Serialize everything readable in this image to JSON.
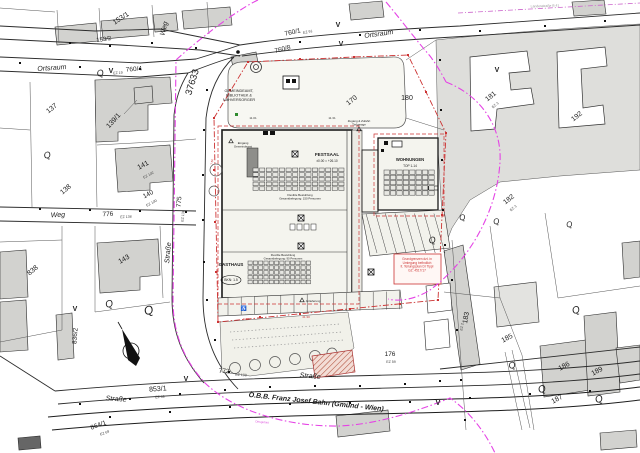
{
  "colors": {
    "ink": "#1c1c1c",
    "line": "#2b2b2b",
    "red": "#cc3333",
    "magenta": "#e543e5",
    "building_gray": "#d2d2cf",
    "zone_gray": "#dededb",
    "site_fill": "#f4f4ee",
    "plaza_fill": "#f7f7f2",
    "green": "#2e8b2e"
  },
  "site": {
    "festsaal": {
      "seat_cols": 14,
      "seat_rows": 5
    },
    "gasthaus": {
      "seat_cols": 12,
      "seat_rows": 5
    },
    "wohnungen": {
      "storage_cols": 8,
      "storage_rows": 5
    },
    "parking": {
      "stalls": 13,
      "diagonal_stalls": 8
    }
  },
  "labels": [
    {
      "id": "street-ortsraum-top",
      "text": "Ortsraum",
      "x": 379,
      "y": 36,
      "rot": -8,
      "size": 7,
      "italic": true
    },
    {
      "id": "street-ortsraum-left",
      "text": "Ortsraum",
      "x": 52,
      "y": 70,
      "rot": -4,
      "size": 7,
      "italic": true
    },
    {
      "id": "street-weg-top",
      "text": "Weg",
      "x": 166,
      "y": 29,
      "rot": -76,
      "size": 7,
      "italic": true
    },
    {
      "id": "street-weg-left",
      "text": "Weg",
      "x": 58,
      "y": 217,
      "rot": -3,
      "size": 7,
      "italic": true
    },
    {
      "id": "street-strasse-left",
      "text": "Straße",
      "x": 170,
      "y": 253,
      "rot": -85,
      "size": 7,
      "italic": true
    },
    {
      "id": "street-strasse-bottom-left",
      "text": "Straße",
      "x": 116,
      "y": 401,
      "rot": 4,
      "size": 7,
      "italic": true
    },
    {
      "id": "street-strasse-bottom-center",
      "text": "Straße",
      "x": 310,
      "y": 378,
      "rot": 5,
      "size": 7,
      "italic": true
    },
    {
      "id": "railway-label",
      "text": "Ö.B.B.  Franz Josef Bahn (Gmünd - Wien)",
      "x": 316,
      "y": 404,
      "rot": 6,
      "size": 7,
      "bold": true,
      "italic": true
    },
    {
      "id": "parcel-153-1",
      "text": "153/1",
      "x": 122,
      "y": 20,
      "rot": -33,
      "size": 7
    },
    {
      "id": "parcel-153-2",
      "text": "153/2",
      "x": 104,
      "y": 41,
      "rot": -8,
      "size": 6
    },
    {
      "id": "parcel-760-1",
      "text": "760/1",
      "x": 293,
      "y": 34,
      "rot": -12,
      "size": 6.5
    },
    {
      "id": "parcel-760-8",
      "text": "760/8",
      "x": 283,
      "y": 51,
      "rot": -14,
      "size": 6.5
    },
    {
      "id": "parcel-760-4",
      "text": "760/4",
      "x": 134,
      "y": 71,
      "rot": -4,
      "size": 6.5
    },
    {
      "id": "parcel-37633",
      "text": "37633",
      "x": 195,
      "y": 83,
      "rot": -73,
      "size": 9.5
    },
    {
      "id": "parcel-137",
      "text": "137",
      "x": 53,
      "y": 110,
      "rot": -38,
      "size": 7
    },
    {
      "id": "parcel-139-1",
      "text": "139/1",
      "x": 115,
      "y": 122,
      "rot": -48,
      "size": 7
    },
    {
      "id": "parcel-138",
      "text": "138",
      "x": 67,
      "y": 191,
      "rot": -40,
      "size": 7
    },
    {
      "id": "parcel-141",
      "text": "141",
      "x": 144,
      "y": 167,
      "rot": -28,
      "size": 7
    },
    {
      "id": "parcel-140",
      "text": "140",
      "x": 149,
      "y": 196,
      "rot": -28,
      "size": 6.5
    },
    {
      "id": "parcel-143",
      "text": "143",
      "x": 125,
      "y": 261,
      "rot": -30,
      "size": 7
    },
    {
      "id": "parcel-776",
      "text": "776",
      "x": 108,
      "y": 216,
      "rot": -3,
      "size": 6.5
    },
    {
      "id": "parcel-775",
      "text": "775",
      "x": 181,
      "y": 202,
      "rot": -85,
      "size": 6.5
    },
    {
      "id": "parcel-838",
      "text": "838",
      "x": 34,
      "y": 272,
      "rot": -40,
      "size": 7
    },
    {
      "id": "parcel-836-2",
      "text": "836/2",
      "x": 77,
      "y": 336,
      "rot": -86,
      "size": 6.5
    },
    {
      "id": "parcel-853-1",
      "text": "853/1",
      "x": 158,
      "y": 391,
      "rot": -4,
      "size": 7
    },
    {
      "id": "parcel-864-1",
      "text": "864/1",
      "x": 99,
      "y": 427,
      "rot": -20,
      "size": 6.5
    },
    {
      "id": "parcel-772",
      "text": "772",
      "x": 224,
      "y": 373,
      "rot": 3,
      "size": 6.5
    },
    {
      "id": "parcel-170",
      "text": "170",
      "x": 353,
      "y": 102,
      "rot": -38,
      "size": 7
    },
    {
      "id": "parcel-180",
      "text": "180",
      "x": 407,
      "y": 100,
      "rot": 0,
      "size": 7
    },
    {
      "id": "parcel-181",
      "text": "181",
      "x": 492,
      "y": 98,
      "rot": -38,
      "size": 7
    },
    {
      "id": "parcel-192",
      "text": "192",
      "x": 578,
      "y": 118,
      "rot": -38,
      "size": 7
    },
    {
      "id": "parcel-182",
      "text": "182",
      "x": 510,
      "y": 201,
      "rot": -38,
      "size": 7
    },
    {
      "id": "parcel-183",
      "text": "183",
      "x": 468,
      "y": 318,
      "rot": -80,
      "size": 7
    },
    {
      "id": "parcel-176",
      "text": "176",
      "x": 390,
      "y": 356,
      "rot": 0,
      "size": 6.5
    },
    {
      "id": "parcel-185",
      "text": "185",
      "x": 508,
      "y": 340,
      "rot": -28,
      "size": 7
    },
    {
      "id": "parcel-186",
      "text": "186",
      "x": 565,
      "y": 368,
      "rot": -28,
      "size": 7
    },
    {
      "id": "parcel-189",
      "text": "189",
      "x": 598,
      "y": 373,
      "rot": -28,
      "size": 7
    },
    {
      "id": "parcel-187",
      "text": "187",
      "x": 558,
      "y": 401,
      "rot": -28,
      "size": 7
    },
    {
      "id": "ez-19",
      "text": "EZ 19",
      "x": 118,
      "y": 74,
      "rot": -4,
      "size": 3.6,
      "color": "#444444"
    },
    {
      "id": "ez-91",
      "text": "EZ 91",
      "x": 308,
      "y": 33,
      "rot": -12,
      "size": 3.6,
      "color": "#444444"
    },
    {
      "id": "ez-102",
      "text": "EZ 102",
      "x": 149,
      "y": 176,
      "rot": -28,
      "size": 3.6,
      "color": "#444444"
    },
    {
      "id": "ez-100",
      "text": "EZ 100",
      "x": 152,
      "y": 204,
      "rot": -28,
      "size": 3.6,
      "color": "#444444"
    },
    {
      "id": "ez-138",
      "text": "EZ 138",
      "x": 126,
      "y": 218,
      "rot": -3,
      "size": 3.6,
      "color": "#444444"
    },
    {
      "id": "ez-136",
      "text": "EZ 136",
      "x": 184,
      "y": 216,
      "rot": -85,
      "size": 3.6,
      "color": "#444444"
    },
    {
      "id": "ez-59-853",
      "text": "EZ 59",
      "x": 160,
      "y": 398,
      "rot": -4,
      "size": 3.6,
      "color": "#444444"
    },
    {
      "id": "ez-69",
      "text": "EZ 69",
      "x": 105,
      "y": 434,
      "rot": -20,
      "size": 3.6,
      "color": "#444444"
    },
    {
      "id": "ez-108",
      "text": "EZ 108",
      "x": 241,
      "y": 376,
      "rot": 3,
      "size": 3.6,
      "color": "#444444"
    },
    {
      "id": "ez-3-181",
      "text": "EZ 3",
      "x": 496,
      "y": 106,
      "rot": -38,
      "size": 3.6,
      "color": "#444444"
    },
    {
      "id": "ez-3-182",
      "text": "EZ 3",
      "x": 514,
      "y": 209,
      "rot": -38,
      "size": 3.6,
      "color": "#444444"
    },
    {
      "id": "ez-2-183",
      "text": "EZ 2",
      "x": 463,
      "y": 327,
      "rot": -80,
      "size": 3.6,
      "color": "#444444"
    },
    {
      "id": "ez-59-176",
      "text": "EZ 59",
      "x": 391,
      "y": 363,
      "rot": 0,
      "size": 3.6,
      "color": "#444444"
    },
    {
      "id": "gemeindeamt-label",
      "lines": [
        "GEMEINDEAMT,",
        "BIBLIOTHEK &",
        "NAHVERSORGER"
      ],
      "x": 239,
      "y": 92,
      "size": 3.8
    },
    {
      "id": "festsaal-label",
      "text": "FESTSAAL",
      "x": 327,
      "y": 156,
      "size": 4.6,
      "bold": true
    },
    {
      "id": "festsaal-level",
      "text": "±0.00 = +26.10",
      "x": 327,
      "y": 162,
      "size": 3.2
    },
    {
      "id": "festsaal-note",
      "lines": [
        "Flexible Bestuhlung",
        "Gesamtbelegung: 150 Personen"
      ],
      "x": 300,
      "y": 196,
      "size": 2.9
    },
    {
      "id": "wohnungen-label",
      "text": "WOHNUNGEN",
      "x": 410,
      "y": 161,
      "size": 4.2,
      "bold": true
    },
    {
      "id": "wohnungen-top",
      "text": "TOP 1-14",
      "x": 410,
      "y": 167,
      "size": 3.2
    },
    {
      "id": "gasthaus-label",
      "text": "GASTHAUS",
      "x": 231,
      "y": 266,
      "size": 4.4,
      "bold": true
    },
    {
      "id": "bkn-badge",
      "text": "BKN: 1.5",
      "x": 231,
      "y": 281,
      "size": 3.4
    },
    {
      "id": "gasthaus-note",
      "lines": [
        "Flexible Bestuhlung",
        "Gesamtbelegung: 90 Personen"
      ],
      "x": 283,
      "y": 256,
      "size": 2.8
    },
    {
      "id": "eingang-gemeindeamt",
      "lines": [
        "Eingang",
        "Gemeindeamt"
      ],
      "x": 243,
      "y": 144,
      "size": 2.9
    },
    {
      "id": "anlieferung-label",
      "text": "Anlieferung",
      "x": 313,
      "y": 302,
      "size": 2.9
    },
    {
      "id": "zugang-tiefgarage",
      "lines": [
        "Zugang & Zufahrt",
        "Tiefgarage"
      ],
      "x": 359,
      "y": 122,
      "size": 2.9
    },
    {
      "id": "legend-note",
      "lines": [
        "Grundgrenzen dzt. in",
        "Umlegung befindlich",
        "lt. Teilungsplan DI Tippl",
        "GZ: 4517/17"
      ],
      "x": 417,
      "y": 260,
      "size": 3.2,
      "color": "#cc3333"
    },
    {
      "id": "landesstrasse-label",
      "text": "Landesstraße B 41",
      "x": 545,
      "y": 7,
      "rot": -2,
      "size": 3.4,
      "color": "#999999"
    },
    {
      "id": "ortsgebiet-label",
      "text": "Ortsgebiet",
      "x": 262,
      "y": 423,
      "rot": 5,
      "size": 3,
      "color": "#dd55dd"
    },
    {
      "id": "dim-1131",
      "text": "11.31",
      "x": 332,
      "y": 119,
      "size": 3,
      "color": "#333333"
    },
    {
      "id": "dim-1101",
      "text": "11.01",
      "x": 253,
      "y": 119,
      "size": 3,
      "color": "#333333"
    },
    {
      "id": "dim-600",
      "text": "6.00",
      "x": 246,
      "y": 320,
      "size": 3,
      "color": "#cc3333"
    },
    {
      "id": "dim-4130",
      "text": "41.30",
      "x": 306,
      "y": 318,
      "size": 3,
      "color": "#cc3333"
    },
    {
      "id": "dim-750",
      "text": "7.50",
      "x": 213,
      "y": 162,
      "rot": -85,
      "size": 3,
      "color": "#cc3333"
    },
    {
      "id": "survey-mark-v-1",
      "text": "V",
      "x": 338,
      "y": 27,
      "size": 7,
      "bold": true
    },
    {
      "id": "survey-mark-v-2",
      "text": "V",
      "x": 341,
      "y": 46,
      "size": 7,
      "bold": true
    },
    {
      "id": "survey-mark-v-3",
      "text": "V",
      "x": 111,
      "y": 73,
      "size": 7,
      "bold": true
    },
    {
      "id": "survey-mark-v-4",
      "text": "V",
      "x": 497,
      "y": 72,
      "size": 7,
      "bold": true
    },
    {
      "id": "survey-mark-v-5",
      "text": "V",
      "x": 75,
      "y": 311,
      "size": 7,
      "bold": true
    },
    {
      "id": "survey-mark-v-6",
      "text": "V",
      "x": 186,
      "y": 381,
      "size": 7,
      "bold": true
    },
    {
      "id": "survey-mark-v-7",
      "text": "V",
      "x": 438,
      "y": 405,
      "size": 7,
      "bold": true
    },
    {
      "id": "garden-symbol-q-1",
      "text": "Q",
      "x": 101,
      "y": 76,
      "rot": -15,
      "size": 9,
      "serif": true,
      "italic": true
    },
    {
      "id": "garden-symbol-q-2",
      "text": "Q",
      "x": 48,
      "y": 158,
      "rot": -15,
      "size": 9,
      "serif": true,
      "italic": true
    },
    {
      "id": "garden-symbol-q-3",
      "text": "Q",
      "x": 110,
      "y": 307,
      "rot": -15,
      "size": 10,
      "serif": true,
      "italic": true
    },
    {
      "id": "garden-symbol-q-4",
      "text": "Q",
      "x": 150,
      "y": 314,
      "rot": -20,
      "size": 12,
      "serif": true,
      "italic": true
    },
    {
      "id": "garden-symbol-q-5",
      "text": "Q",
      "x": 433,
      "y": 243,
      "rot": -15,
      "size": 9,
      "serif": true,
      "italic": true
    },
    {
      "id": "garden-symbol-q-6",
      "text": "Q",
      "x": 463,
      "y": 220,
      "rot": -15,
      "size": 8,
      "serif": true,
      "italic": true
    },
    {
      "id": "garden-symbol-q-7",
      "text": "Q",
      "x": 497,
      "y": 224,
      "rot": -15,
      "size": 8,
      "serif": true,
      "italic": true
    },
    {
      "id": "garden-symbol-q-8",
      "text": "Q",
      "x": 570,
      "y": 227,
      "rot": -15,
      "size": 8,
      "serif": true,
      "italic": true
    },
    {
      "id": "garden-symbol-q-9",
      "text": "Q",
      "x": 577,
      "y": 313,
      "rot": -20,
      "size": 10,
      "serif": true,
      "italic": true
    },
    {
      "id": "garden-symbol-q-10",
      "text": "Q",
      "x": 513,
      "y": 368,
      "rot": -20,
      "size": 9,
      "serif": true,
      "italic": true
    },
    {
      "id": "garden-symbol-q-11",
      "text": "Q",
      "x": 543,
      "y": 392,
      "rot": -20,
      "size": 10,
      "serif": true,
      "italic": true
    },
    {
      "id": "garden-symbol-q-12",
      "text": "Q",
      "x": 600,
      "y": 402,
      "rot": -20,
      "size": 10,
      "serif": true,
      "italic": true
    },
    {
      "id": "wheelchair-symbol",
      "text": "♿",
      "x": 244,
      "y": 310,
      "size": 5,
      "color": "#222222"
    }
  ]
}
